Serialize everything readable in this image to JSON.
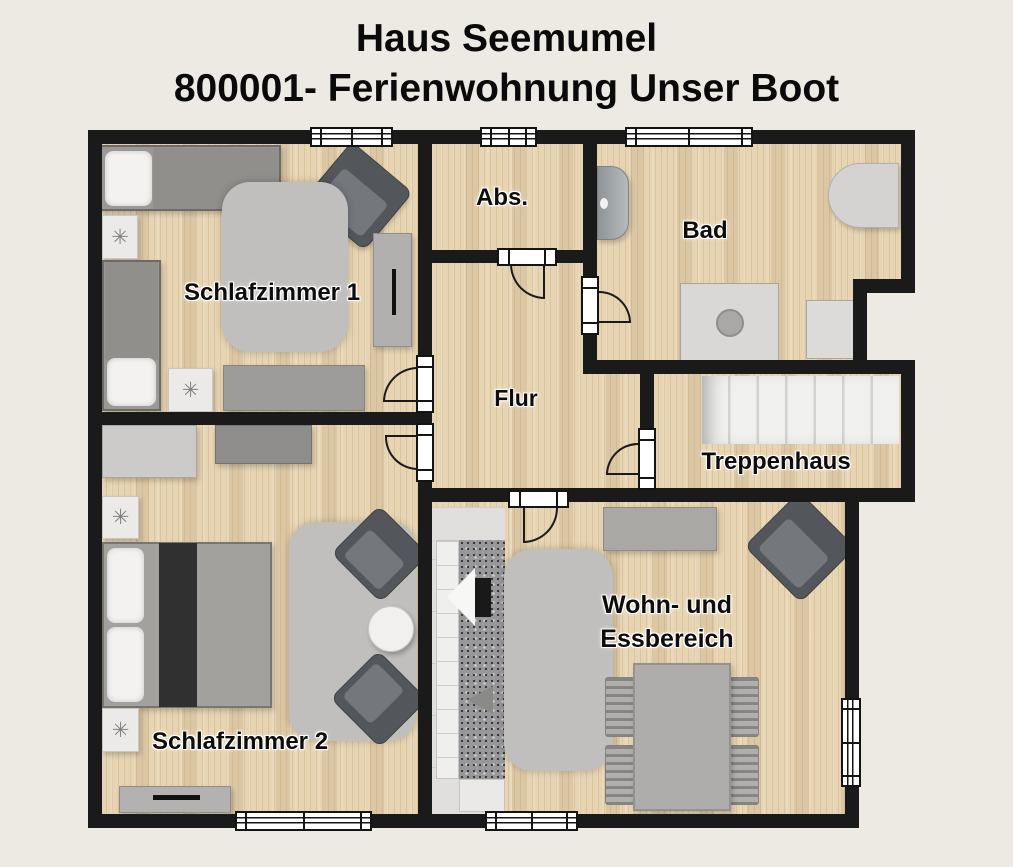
{
  "title": {
    "line1": "Haus Seemumel",
    "line2": "800001- Ferienwohnung Unser Boot"
  },
  "rooms": {
    "schlafzimmer1": {
      "label": "Schlafzimmer 1"
    },
    "schlafzimmer2": {
      "label": "Schlafzimmer 2"
    },
    "abstellraum": {
      "label": "Abs."
    },
    "bad": {
      "label": "Bad"
    },
    "flur": {
      "label": "Flur"
    },
    "treppenhaus": {
      "label": "Treppenhaus"
    },
    "wohn_essbereich": {
      "label_line1": "Wohn- und",
      "label_line2": "Essbereich"
    }
  },
  "icons": {
    "decor_star": "✳"
  },
  "colors": {
    "background": "#edeae3",
    "wall": "#1a1a1a",
    "floor_wood": "#e7d4b2",
    "floor_tile": "#e0dfdd",
    "rug": "#c0bfbd",
    "furniture_dark": "#53575c",
    "stairs": "#f0f0ee"
  }
}
